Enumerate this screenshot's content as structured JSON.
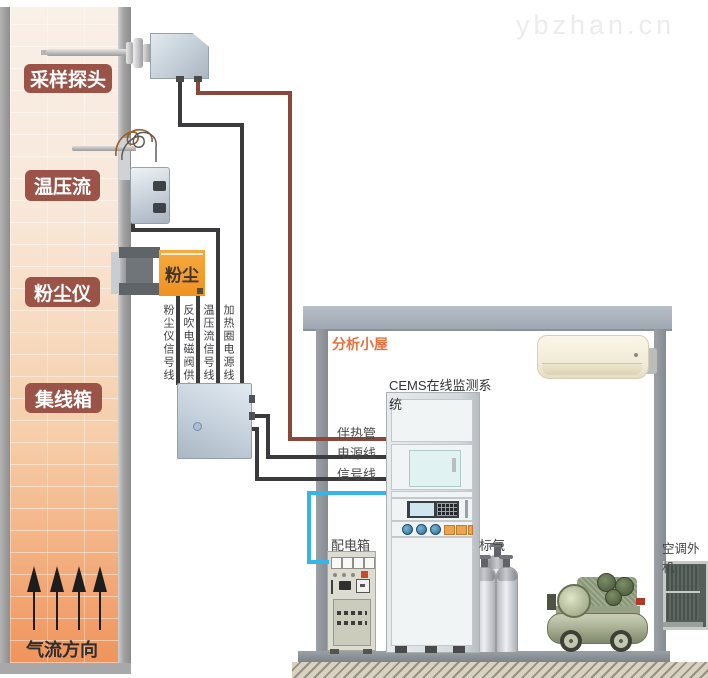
{
  "watermark": {
    "text": "ybzhan.cn"
  },
  "stack": {
    "labels": {
      "sampling_probe": "采样探头",
      "temp_pressure_flow": "温压流",
      "dust_meter": "粉尘仪",
      "junction_box": "集线箱"
    },
    "dust_meter_device_text": "粉尘",
    "flow_direction": "气流方向"
  },
  "wires": {
    "vertical_labels": [
      "粉尘仪信号线",
      "反吹电磁阀供电线",
      "温压流信号线",
      "加热圈电源线"
    ],
    "cabin_inlet_labels": [
      "伴热管",
      "电源线",
      "信号线"
    ],
    "colors": {
      "signal_black": "#3b3b3d",
      "heated_sample_brown": "#8b4738",
      "control_blue": "#35b6e9"
    }
  },
  "cabin": {
    "title": "分析小屋",
    "cems_label": "CEMS在线监测系统",
    "distribution_box": "配电箱",
    "standard_gas": "标气",
    "ac_outdoor": "空调外机"
  }
}
